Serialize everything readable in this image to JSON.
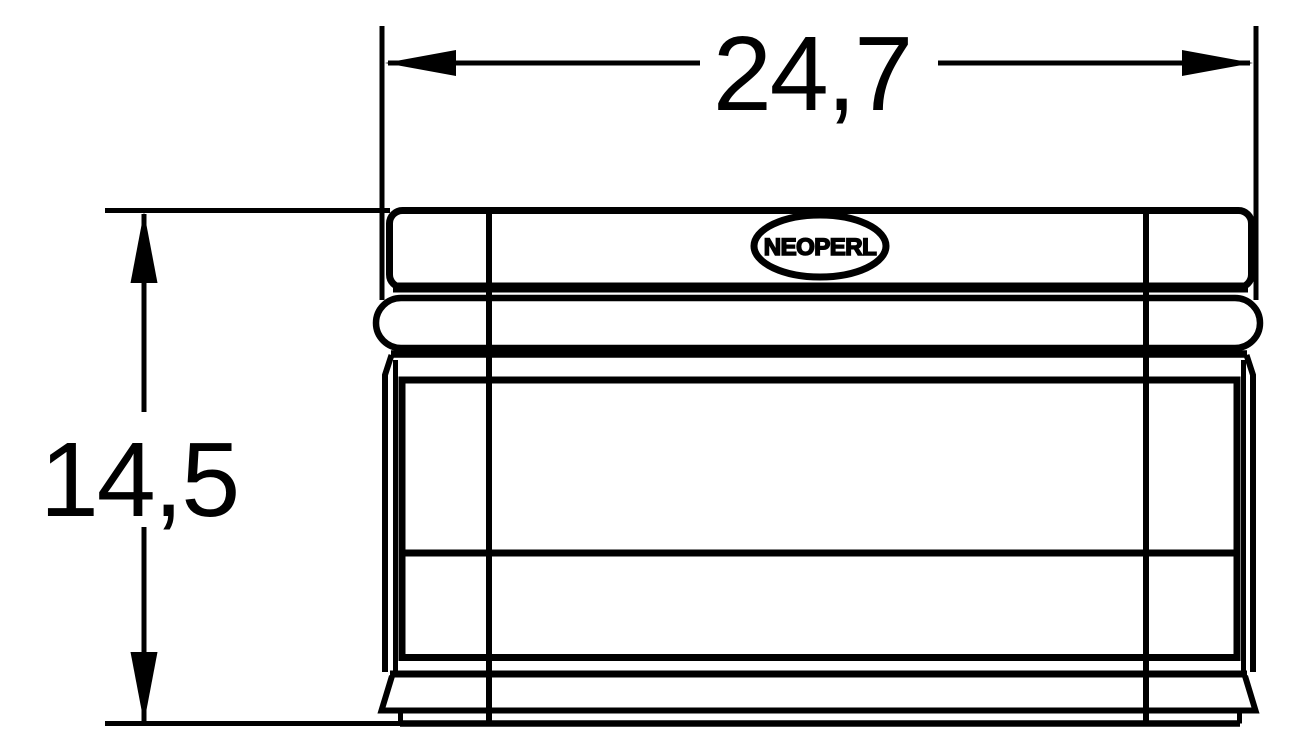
{
  "drawing": {
    "background_color": "#ffffff",
    "line_color": "#000000",
    "dimensions": {
      "width": {
        "value": "24,7"
      },
      "height": {
        "value": "14,5"
      }
    },
    "logo": {
      "text": "NEOPERL"
    }
  }
}
